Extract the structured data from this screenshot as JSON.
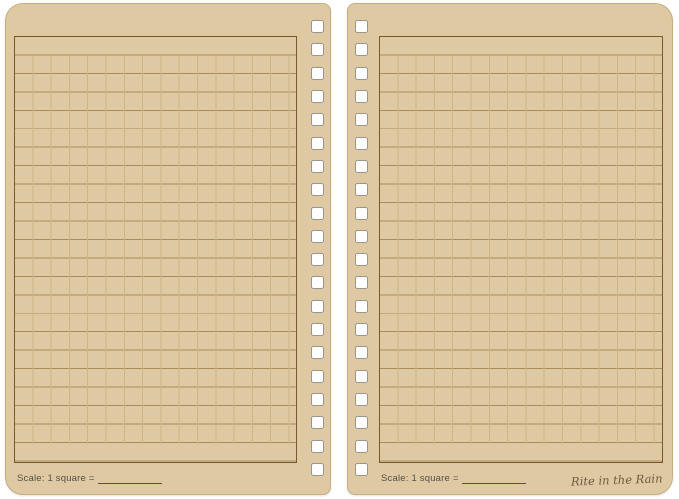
{
  "document": {
    "kind": "notebook-spread",
    "pattern": "universal-ruled-grid"
  },
  "colors": {
    "background": "#ffffff",
    "page": "#dfc9a2",
    "page_edge": "#c6ae82",
    "frame_border": "#76592f",
    "grid_line_strong": "#aa8c5c",
    "grid_line_faint": "#cdb588",
    "hole_fill": "#ffffff",
    "hole_border": "#99968f",
    "text": "#55504a",
    "logo": "#6b5b41"
  },
  "grid": {
    "rows": 23,
    "row_height_px": 18.45,
    "column_width_px": 18.3,
    "holes_per_page": 20
  },
  "pages": [
    {
      "side": "left",
      "scale_label": "Scale: 1 square ="
    },
    {
      "side": "right",
      "scale_label": "Scale: 1 square =",
      "logo_text": "Rite in the Rain"
    }
  ]
}
